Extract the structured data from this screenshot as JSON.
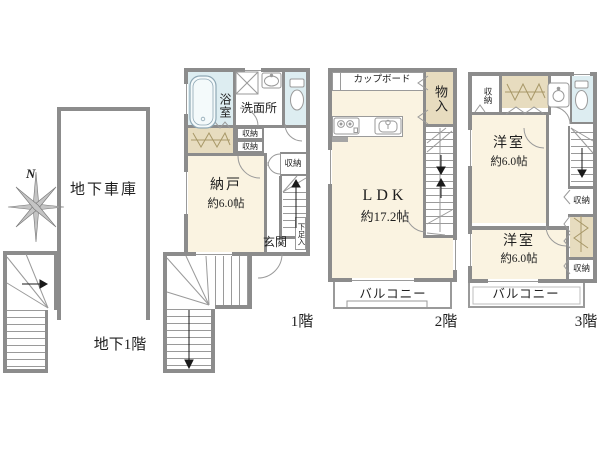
{
  "colors": {
    "wall": "#8c8c8c",
    "thin_line": "#9a9a9a",
    "room_cream": "#faf3e1",
    "wet_area_blue": "#ddedf1",
    "closet_tan": "#e7dcbf",
    "background": "#ffffff",
    "text": "#1f1f1f"
  },
  "compass": {
    "north_label": "N"
  },
  "basement": {
    "garage_label": "地下車庫",
    "floor_label": "地下1階"
  },
  "floor1": {
    "floor_label": "1階",
    "bathroom_label": "浴室",
    "washroom_label": "洗面所",
    "storage_label_a": "収納",
    "storage_label_b": "収納",
    "storage_label_right": "収納",
    "storeroom_label": "納戸",
    "storeroom_size": "約6.0帖",
    "entrance_label": "玄関",
    "shoe_cabinet_label": "下足入"
  },
  "floor2": {
    "floor_label": "2階",
    "cupboard_label": "カップボード",
    "closet_label": "物入",
    "ldk_label": "LDK",
    "ldk_size": "約17.2帖",
    "balcony_label": "バルコニー"
  },
  "floor3": {
    "floor_label": "3階",
    "storage_top_label": "収納",
    "storage_mid_label": "収納",
    "storage_bottom_label": "収納",
    "room_upper_label": "洋室",
    "room_upper_size": "約6.0帖",
    "room_lower_label": "洋室",
    "room_lower_size": "約6.0帖",
    "balcony_label": "バルコニー"
  }
}
